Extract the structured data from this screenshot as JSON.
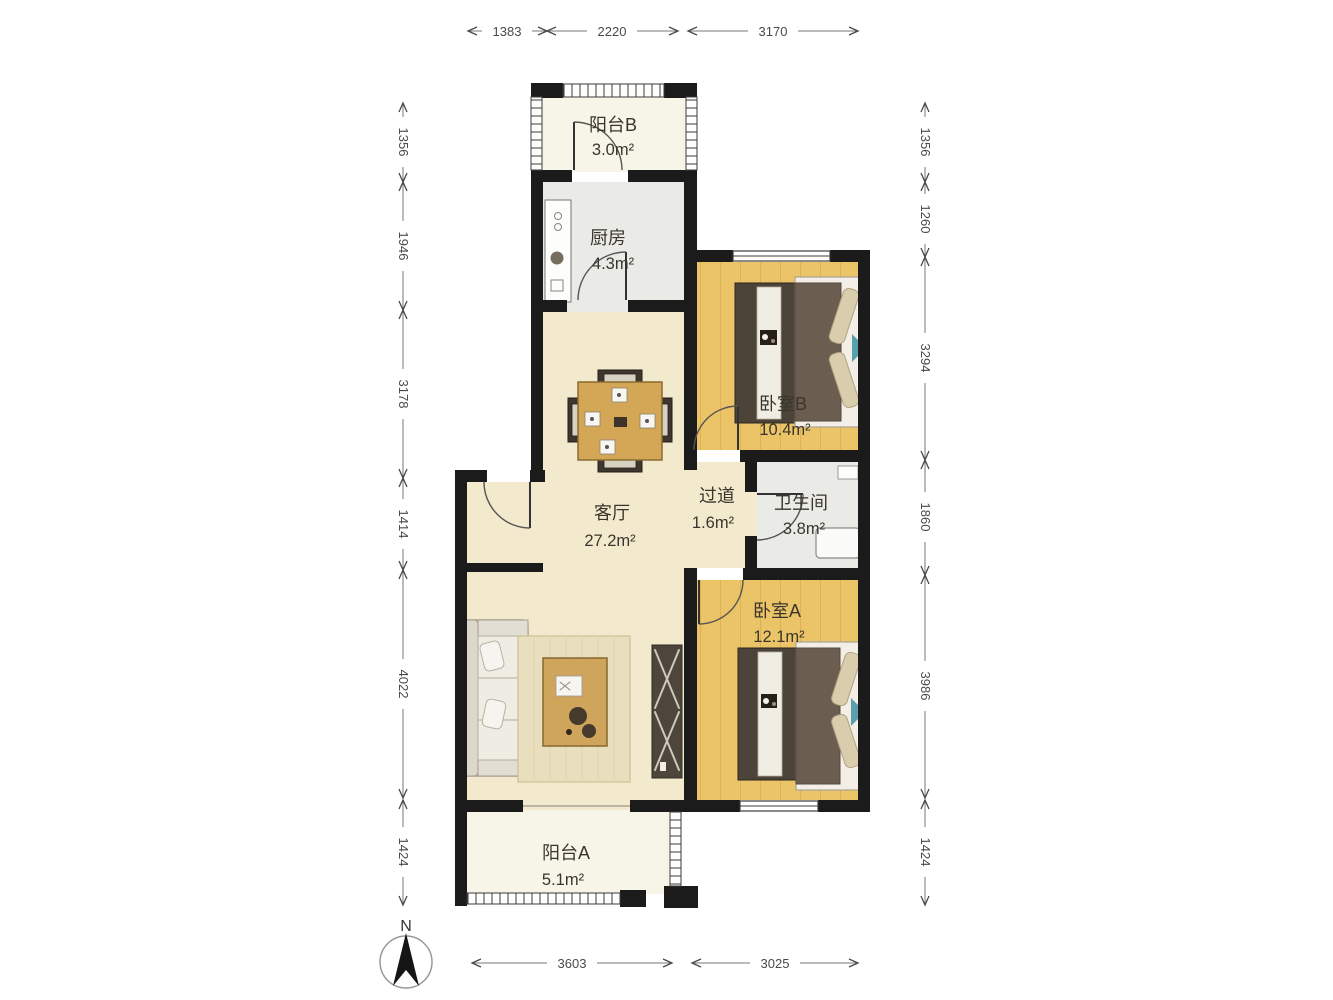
{
  "plan": {
    "title": "floor-plan",
    "rooms": [
      {
        "id": "balcony-b",
        "name": "阳台B",
        "area": "3.0m²"
      },
      {
        "id": "kitchen",
        "name": "厨房",
        "area": "4.3m²"
      },
      {
        "id": "bedroom-b",
        "name": "卧室B",
        "area": "10.4m²"
      },
      {
        "id": "living-room",
        "name": "客厅",
        "area": "27.2m²"
      },
      {
        "id": "corridor",
        "name": "过道",
        "area": "1.6m²"
      },
      {
        "id": "bathroom",
        "name": "卫生间",
        "area": "3.8m²"
      },
      {
        "id": "bedroom-a",
        "name": "卧室A",
        "area": "12.1m²"
      },
      {
        "id": "balcony-a",
        "name": "阳台A",
        "area": "5.1m²"
      }
    ],
    "dimensions": {
      "top": [
        "1383",
        "2220",
        "3170"
      ],
      "bottom": [
        "3603",
        "3025"
      ],
      "left": [
        "1356",
        "1946",
        "3178",
        "1414",
        "4022",
        "1424"
      ],
      "right": [
        "1356",
        "1260",
        "3294",
        "1860",
        "3986",
        "1424"
      ]
    },
    "compass": {
      "label": "N"
    },
    "colors": {
      "wall": "#1b1b1b",
      "living_floor": "#f3e9cc",
      "wood_floor": "#ecc468",
      "wood_line": "#d9a94e",
      "gray_floor": "#eaeae6",
      "balcony_floor": "#f7f4e8",
      "accent_teal": "#58a0b0",
      "furniture_dark": "#4d4439",
      "blanket": "#6b5e50"
    }
  }
}
